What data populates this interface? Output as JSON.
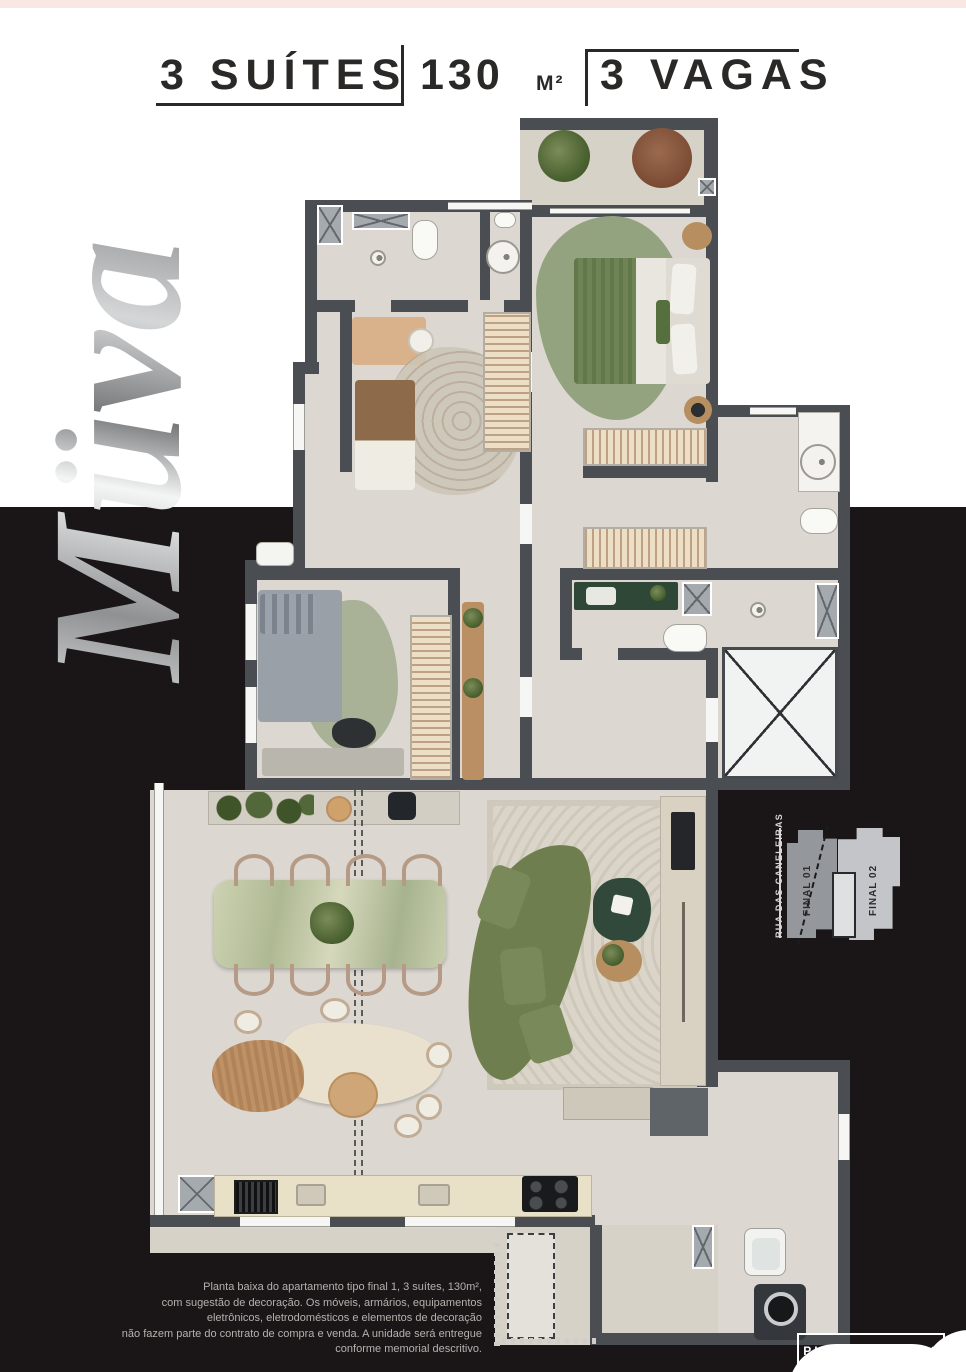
{
  "header": {
    "suites": "3 SUÍTES",
    "area_value": "130",
    "area_unit": "M²",
    "parking": "3 VAGAS"
  },
  "brand": {
    "logo": "Müva"
  },
  "key_plan": {
    "street": "RUA DAS CANELEIRAS",
    "final_01": "FINAL 01",
    "final_02": "FINAL 02"
  },
  "disclaimer": {
    "lines": [
      "Planta baixa do apartamento tipo final 1, 3 suítes, 130m²,",
      "com sugestão de decoração. Os móveis, armários, equipamentos",
      "eletrônicos, eletrodomésticos e elementos de decoração",
      "não fazem parte do contrato de compra e venda. A unidade será entregue",
      "conforme memorial descritivo."
    ]
  },
  "badge": {
    "label": "PLANTA TIPO 1°"
  },
  "colors": {
    "wall": "#4a4e53",
    "floor": "#dcd8d1",
    "accent_green": "#6e7e4f",
    "background_black": "#1a1617",
    "top_strip_pink": "#f8e7e3"
  }
}
